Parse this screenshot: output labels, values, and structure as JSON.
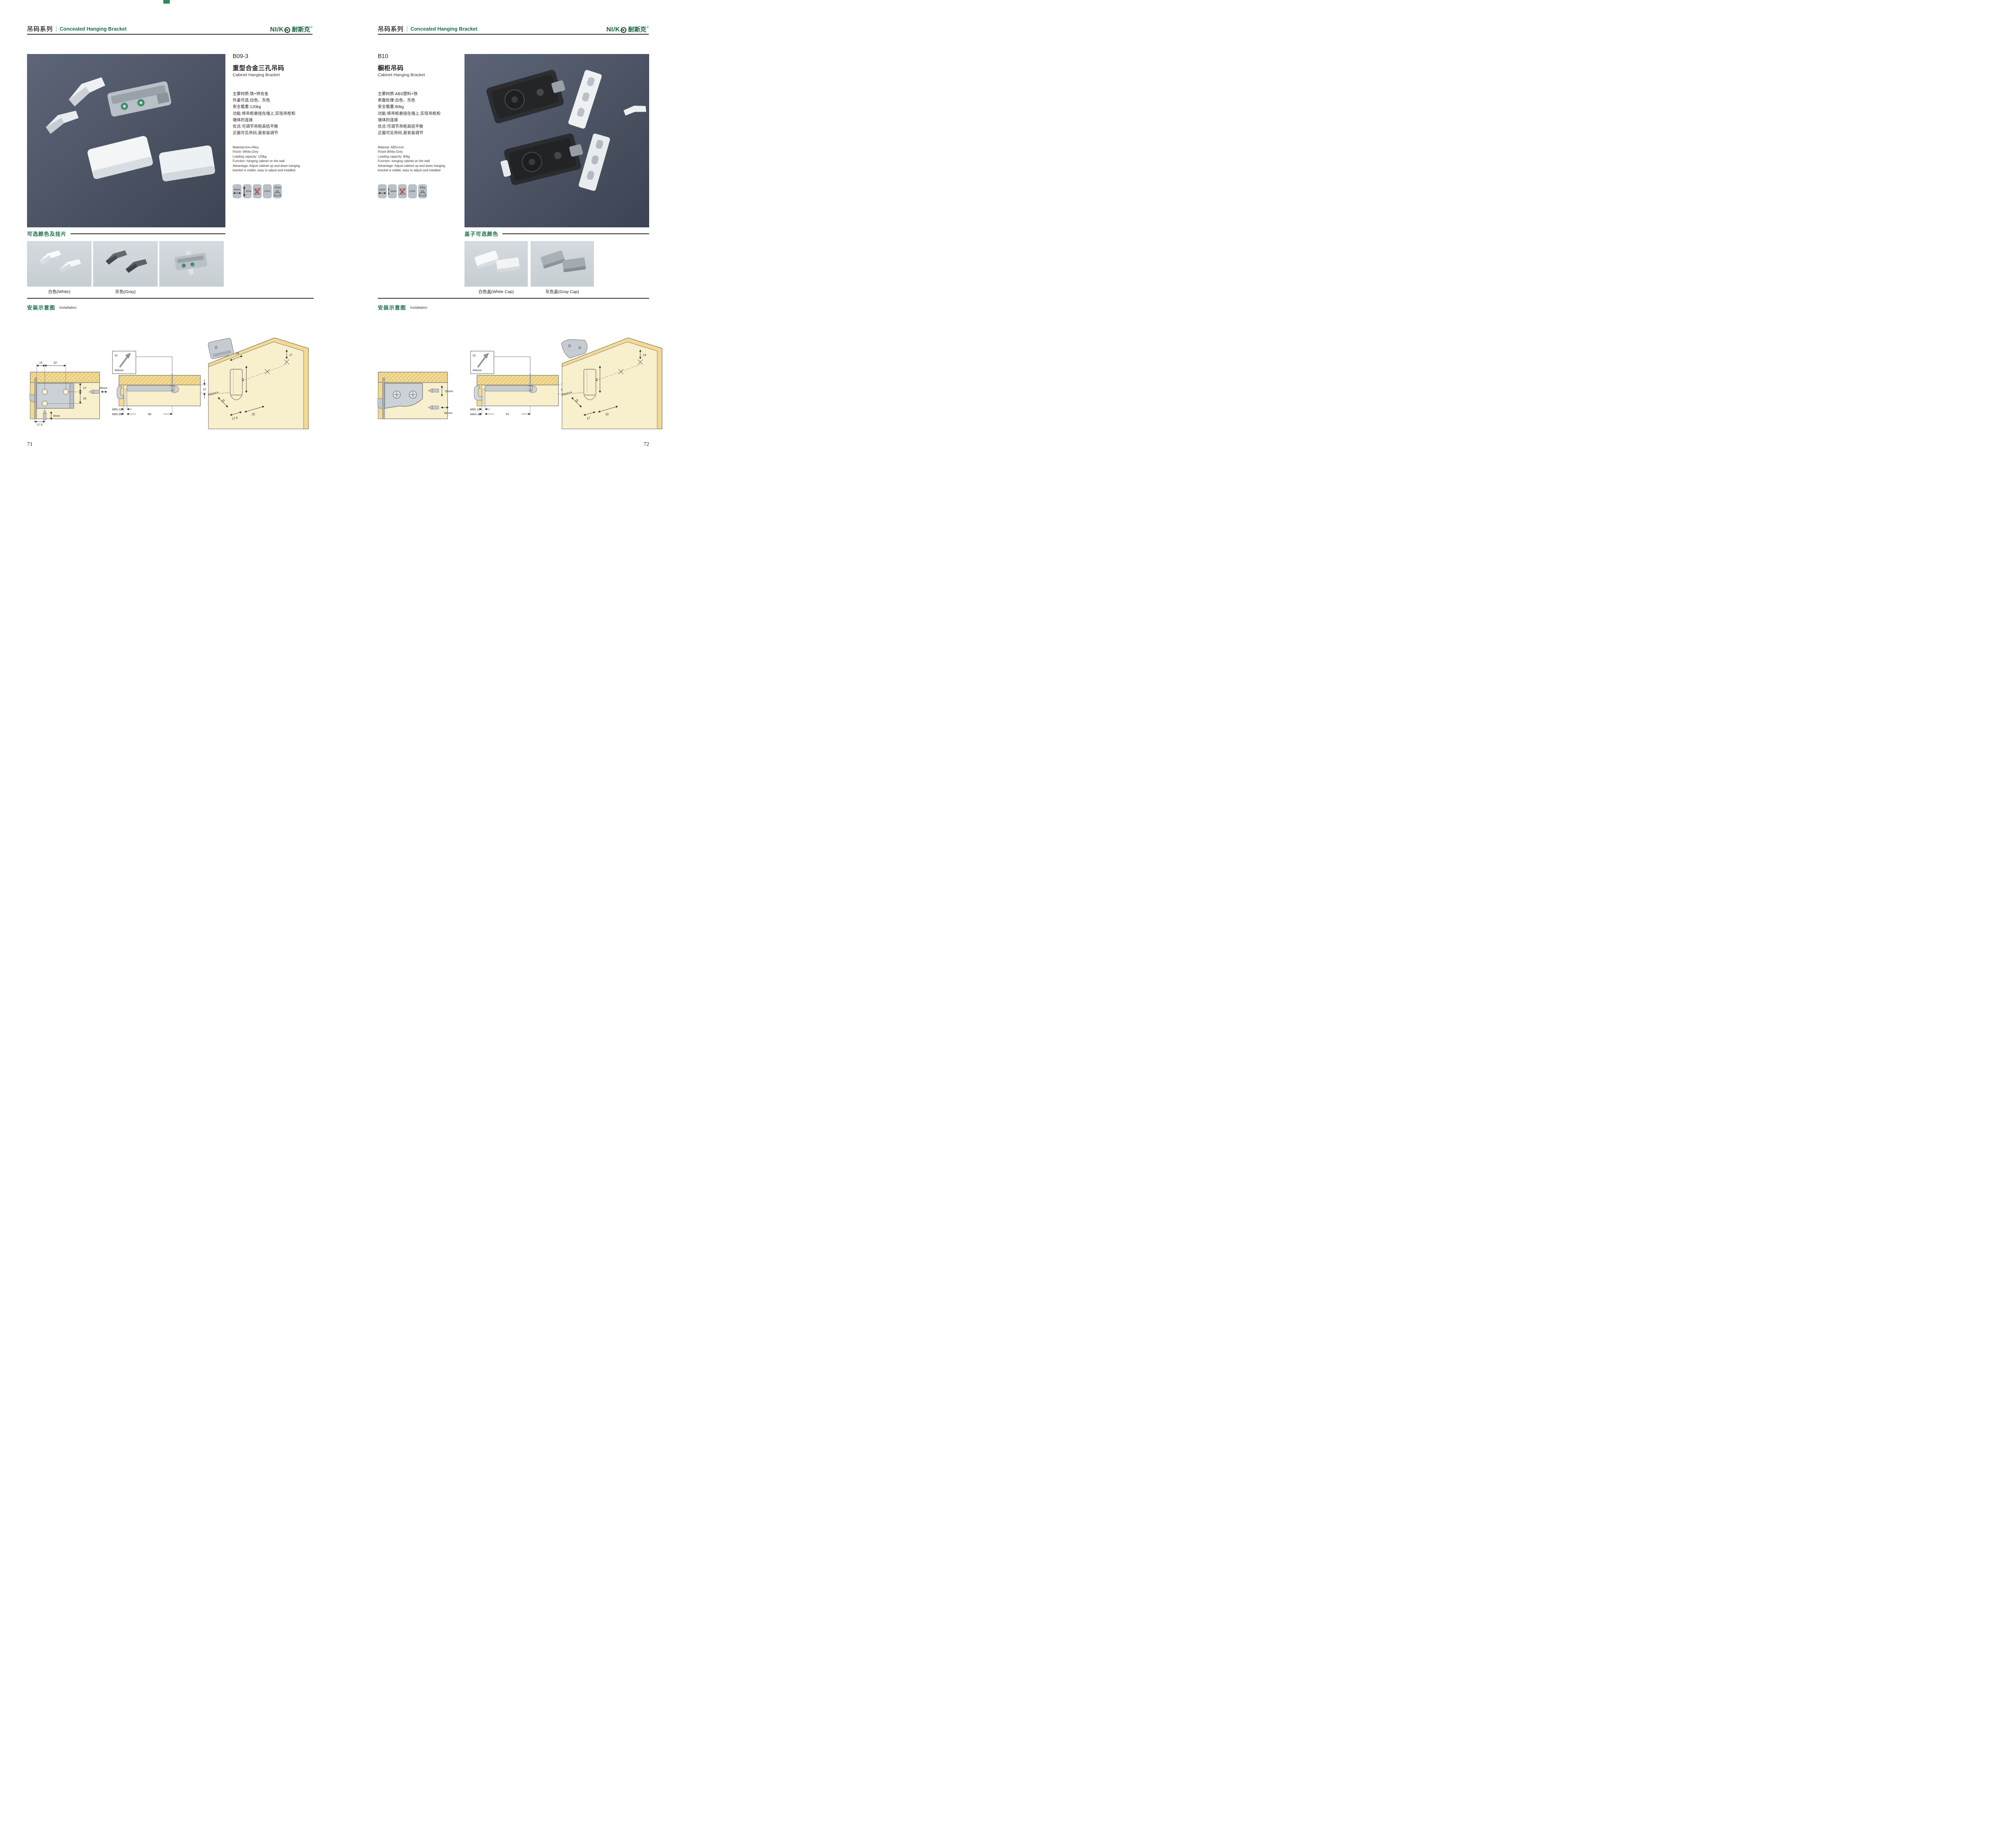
{
  "brand": {
    "latin": "NI/K",
    "cjk": "耐斯克",
    "registered": "®"
  },
  "header": {
    "series_cn": "吊码系列",
    "series_en": "Concealed Hanging Bracket"
  },
  "pages": {
    "left": {
      "page_number": "71",
      "product": {
        "code": "B09-3",
        "name_cn": "重型合金三孔吊码",
        "name_en": "Cabinet Hanging Bracket",
        "specs_cn": [
          "主要材质:铁+锌合金",
          "外盖可选:白色、灰色",
          "安全载重:120kg",
          "功能:将吊柜悬挂在墙上,实现吊柜和",
          "墙体的连接",
          "优点:可调节吊柜高低平衡",
          "正面可见吊码,易安装调节"
        ],
        "specs_en": [
          "Material:Iron+Alloy",
          "Finish: White,Grey",
          "Loading capacity: 120kg",
          "Function: hanging cabinet on the wall",
          "Advantage: Adjust cabinet up and down hanging",
          "bracket is visible, easy to adjust and installed"
        ],
        "icons": {
          "dim1": "20mm",
          "dim2": "6mm",
          "cert": "LGA",
          "load": "120Kg"
        }
      },
      "colors_section": {
        "title": "可选颜色及挂片",
        "caption1": "白色(White)",
        "caption2": "灰色(Gray)"
      },
      "install": {
        "title_cn": "安装示意图",
        "title_en": "Installation",
        "d1": {
          "top1": "16",
          "top2": "32",
          "r1": "17",
          "r2": "25",
          "drill1": "20mm",
          "drill2": "6mm",
          "bottom": "17.5"
        },
        "d2": {
          "count": "2x",
          "dia": "Φ4mm",
          "right": "12",
          "row1": "MIN.12",
          "row2": "MIN.35",
          "len": "58"
        },
        "d3": {
          "top": "16",
          "right": "17",
          "vert": "42",
          "radius": "RMAX4",
          "diag": "16",
          "b1": "17.5",
          "b2": "32"
        }
      }
    },
    "right": {
      "page_number": "72",
      "product": {
        "code": "B10",
        "name_cn": "橱柜吊码",
        "name_en": "Cabinet Hanging Bracket",
        "specs_cn": [
          "主要材质:ABS塑料+铁",
          "表面处理:白色、灰色",
          "安全载重:80kg",
          "功能:将吊柜悬挂在墙上,实现吊柜和",
          "墙体的连接",
          "优点:可调节吊柜高低平衡",
          "正面可见吊码,易安装调节"
        ],
        "specs_en": [
          "Material: ABS+iron",
          "Finish:White,Grey",
          "Loading capacity: 80kg",
          "Function: hanging cabinet on the wall",
          "Advantage: Adjust cabinet up and down hanging",
          "bracket is visible, easy to adjust and installed"
        ],
        "icons": {
          "dim1": "10mm",
          "dim2": "15mm",
          "cert": "LGA",
          "load": "80Kg"
        }
      },
      "colors_section": {
        "title": "盖子可选颜色",
        "caption1": "白色盖(White Cap)",
        "caption2": "灰色盖(Gray Cap)"
      },
      "install": {
        "title_cn": "安装示意图",
        "title_en": "Installation",
        "d1": {
          "drill1": "15mm",
          "drill2": "10mm"
        },
        "d2": {
          "count": "2x",
          "dia": "Φ4mm",
          "right": "18",
          "row1": "MIN.12",
          "row2": "MAX.30",
          "len": "67"
        },
        "d3": {
          "right": "13",
          "vert": "42",
          "radius": "RMAX4",
          "diag": "19",
          "b1": "17",
          "b2": "32"
        }
      }
    }
  }
}
